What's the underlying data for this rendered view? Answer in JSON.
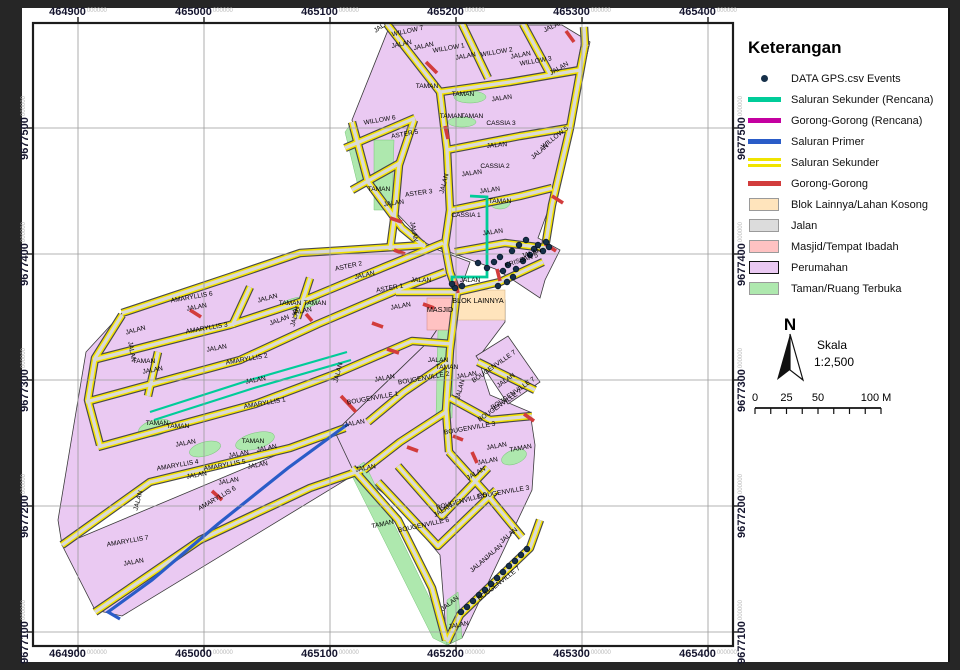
{
  "legend": {
    "title": "Keterangan",
    "items": [
      {
        "name": "gps-events",
        "label": "DATA GPS.csv Events",
        "swatch": "point",
        "color": "#16304a"
      },
      {
        "name": "saluran-sekunder-rencana",
        "label": "Saluran Sekunder (Rencana)",
        "swatch": "line",
        "color": "#00cc99"
      },
      {
        "name": "gorong-gorong-rencana",
        "label": "Gorong-Gorong (Rencana)",
        "swatch": "line",
        "color": "#c400a0"
      },
      {
        "name": "saluran-primer",
        "label": "Saluran Primer",
        "swatch": "line",
        "color": "#2a5cc8"
      },
      {
        "name": "saluran-sekunder",
        "label": "Saluran Sekunder",
        "swatch": "dline",
        "color": "#f0e400"
      },
      {
        "name": "gorong-gorong",
        "label": "Gorong-Gorong",
        "swatch": "line",
        "color": "#d23c3c"
      },
      {
        "name": "blok-lainnya",
        "label": "Blok Lainnya/Lahan Kosong",
        "swatch": "fill",
        "color": "#ffe4bc"
      },
      {
        "name": "jalan",
        "label": "Jalan",
        "swatch": "fill",
        "color": "#dcdcdc"
      },
      {
        "name": "masjid",
        "label": "Masjid/Tempat Ibadah",
        "swatch": "fill",
        "color": "#ffc2c2"
      },
      {
        "name": "perumahan",
        "label": "Perumahan",
        "swatch": "fill-border",
        "color": "#eac9f2"
      },
      {
        "name": "taman",
        "label": "Taman/Ruang Terbuka",
        "swatch": "fill",
        "color": "#aee8ae"
      }
    ]
  },
  "north": {
    "label": "N"
  },
  "scale": {
    "title": "Skala",
    "ratio": "1:2,500",
    "bar_labels": [
      "0",
      "25",
      "50",
      "100 M"
    ]
  },
  "axes": {
    "suffix": "000000",
    "x": [
      {
        "value": "464900",
        "px": 78
      },
      {
        "value": "465000",
        "px": 204
      },
      {
        "value": "465100",
        "px": 330
      },
      {
        "value": "465200",
        "px": 456
      },
      {
        "value": "465300",
        "px": 582
      },
      {
        "value": "465400",
        "px": 708
      }
    ],
    "y": [
      {
        "value": "9677500",
        "px": 128
      },
      {
        "value": "9677400",
        "px": 254
      },
      {
        "value": "9677300",
        "px": 380
      },
      {
        "value": "9677200",
        "px": 506
      },
      {
        "value": "9677100",
        "px": 632
      }
    ]
  },
  "map": {
    "labels": [
      [
        "JALAN",
        384,
        27,
        -35
      ],
      [
        "WILLOW 7",
        408,
        33,
        -12
      ],
      [
        "JALAN",
        402,
        46,
        -12
      ],
      [
        "JALAN",
        424,
        48,
        -12
      ],
      [
        "WILLOW 1",
        449,
        50,
        -10
      ],
      [
        "JALAN",
        466,
        58,
        -10
      ],
      [
        "WILLOW 2",
        497,
        54,
        -10
      ],
      [
        "JALAN",
        521,
        57,
        -10
      ],
      [
        "WILLOW 3",
        536,
        63,
        -10
      ],
      [
        "JALAN",
        554,
        28,
        -25
      ],
      [
        "JALAN",
        560,
        70,
        -30
      ],
      [
        "TAMAN",
        427,
        88,
        0
      ],
      [
        "TAMAN",
        463,
        96,
        0
      ],
      [
        "JALAN",
        502,
        100,
        -8
      ],
      [
        "TAMAN",
        451,
        118,
        0
      ],
      [
        "TAMAN",
        472,
        118,
        0
      ],
      [
        "CASSIA 3",
        501,
        125,
        0
      ],
      [
        "WILLOW 6",
        380,
        122,
        -10
      ],
      [
        "ASTER 5",
        405,
        136,
        -10
      ],
      [
        "WILLOW 5",
        556,
        139,
        -38
      ],
      [
        "JALAN",
        497,
        147,
        -5
      ],
      [
        "JALAN",
        541,
        153,
        -40
      ],
      [
        "TAMAN",
        379,
        191,
        0
      ],
      [
        "JALAN",
        394,
        205,
        -8
      ],
      [
        "ASTER 3",
        419,
        195,
        -8
      ],
      [
        "JALAN",
        446,
        184,
        -75
      ],
      [
        "CASSIA 2",
        495,
        168,
        0
      ],
      [
        "JALAN",
        472,
        175,
        -8
      ],
      [
        "JALAN",
        490,
        192,
        -8
      ],
      [
        "TAMAN",
        500,
        203,
        0
      ],
      [
        "CASSIA 1",
        466,
        217,
        0
      ],
      [
        "JALAN",
        412,
        232,
        80
      ],
      [
        "JALAN",
        493,
        234,
        -8
      ],
      [
        "ASTER 2",
        349,
        268,
        -12
      ],
      [
        "JALAN",
        365,
        277,
        -12
      ],
      [
        "ASTER 1",
        390,
        290,
        -10
      ],
      [
        "JALAN",
        401,
        308,
        -10
      ],
      [
        "JALAN",
        268,
        300,
        -15
      ],
      [
        "AMARYLLIS 6",
        192,
        299,
        -10
      ],
      [
        "JALAN",
        197,
        309,
        -10
      ],
      [
        "TAMAN",
        290,
        305,
        0
      ],
      [
        "TAMAN",
        315,
        305,
        0
      ],
      [
        "JALAN",
        302,
        313,
        -10
      ],
      [
        "JALAN",
        136,
        332,
        -15
      ],
      [
        "AMARYLLIS 3",
        207,
        330,
        -10
      ],
      [
        "JALAN",
        280,
        322,
        -20
      ],
      [
        "JALAN",
        297,
        317,
        -75
      ],
      [
        "JALAN",
        130,
        352,
        80
      ],
      [
        "TAMAN",
        144,
        363,
        0
      ],
      [
        "JALAN",
        153,
        372,
        -10
      ],
      [
        "JALAN",
        217,
        350,
        -10
      ],
      [
        "AMARYLLIS 2",
        247,
        361,
        -10
      ],
      [
        "JALAN",
        256,
        382,
        -10
      ],
      [
        "AMARYLLIS 1",
        265,
        405,
        -10
      ],
      [
        "TAMAN",
        157,
        425,
        0
      ],
      [
        "TAMAN",
        178,
        428,
        0
      ],
      [
        "JALAN",
        186,
        445,
        -10
      ],
      [
        "TAMAN",
        253,
        443,
        0
      ],
      [
        "JALAN",
        239,
        456,
        -10
      ],
      [
        "JALAN",
        267,
        450,
        -10
      ],
      [
        "AMARYLLIS 4",
        178,
        467,
        -10
      ],
      [
        "AMARYLLIS 5",
        225,
        467,
        -10
      ],
      [
        "JALAN",
        258,
        467,
        -10
      ],
      [
        "JALAN",
        197,
        477,
        -10
      ],
      [
        "JALAN",
        229,
        483,
        -10
      ],
      [
        "JALAN",
        140,
        501,
        -75
      ],
      [
        "AMARYLLIS 6",
        218,
        500,
        -30
      ],
      [
        "AMARYLLIS 7",
        128,
        543,
        -10
      ],
      [
        "JALAN",
        134,
        564,
        -10
      ],
      [
        "JALAN",
        340,
        373,
        -75
      ],
      [
        "JALAN",
        385,
        380,
        -10
      ],
      [
        "BOUGENVILLE 2",
        424,
        380,
        -10
      ],
      [
        "JALAN",
        438,
        362,
        0
      ],
      [
        "TAMAN",
        447,
        369,
        0
      ],
      [
        "BOUGENVILLE 1",
        373,
        400,
        -10
      ],
      [
        "JALAN",
        355,
        425,
        -10
      ],
      [
        "BOUGENVILLE 7",
        495,
        368,
        -35
      ],
      [
        "JALAN",
        467,
        377,
        -10
      ],
      [
        "JALAN",
        507,
        382,
        -35
      ],
      [
        "BOUGENVILLE 7",
        514,
        395,
        -35
      ],
      [
        "BOUGENVILLE 7",
        501,
        407,
        -35
      ],
      [
        "JALAN",
        462,
        390,
        -75
      ],
      [
        "BOUGENVILLE 3",
        470,
        430,
        -10
      ],
      [
        "JALAN",
        497,
        448,
        -10
      ],
      [
        "TAMAN",
        521,
        450,
        -10
      ],
      [
        "JALAN",
        488,
        463,
        -10
      ],
      [
        "JALAN",
        366,
        470,
        -10
      ],
      [
        "JALAN",
        477,
        475,
        -30
      ],
      [
        "JALAN",
        444,
        512,
        -30
      ],
      [
        "BOUGENVILLE 5",
        462,
        503,
        -15
      ],
      [
        "BOUGENVILLE 3",
        504,
        494,
        -10
      ],
      [
        "TAMAN",
        383,
        526,
        -12
      ],
      [
        "BOUGENVILLE 6",
        424,
        527,
        -12
      ],
      [
        "JALAN",
        510,
        537,
        -40
      ],
      [
        "JALAN",
        495,
        553,
        -40
      ],
      [
        "JALAN",
        480,
        566,
        -40
      ],
      [
        "BOUGENVILLE 7",
        500,
        585,
        -38
      ],
      [
        "JALAN",
        451,
        605,
        -38
      ],
      [
        "JALAN",
        459,
        627,
        -10
      ],
      [
        "MASJID",
        440,
        312,
        0,
        7.2
      ],
      [
        "BLOK LAINNYA",
        478,
        303,
        0,
        7.2
      ],
      [
        "KRISSAN 5",
        522,
        262,
        -18
      ],
      [
        "JALAN",
        532,
        255,
        -18
      ],
      [
        "JALAN",
        470,
        282,
        0
      ],
      [
        "JALAN",
        421,
        282,
        0
      ]
    ],
    "gps_points": [
      [
        455,
        288
      ],
      [
        462,
        286
      ],
      [
        452,
        284
      ],
      [
        478,
        263
      ],
      [
        487,
        268
      ],
      [
        494,
        262
      ],
      [
        500,
        257
      ],
      [
        503,
        271
      ],
      [
        508,
        265
      ],
      [
        512,
        251
      ],
      [
        516,
        269
      ],
      [
        519,
        245
      ],
      [
        523,
        261
      ],
      [
        526,
        240
      ],
      [
        530,
        255
      ],
      [
        534,
        249
      ],
      [
        538,
        245
      ],
      [
        543,
        251
      ],
      [
        546,
        242
      ],
      [
        549,
        247
      ],
      [
        498,
        286
      ],
      [
        507,
        282
      ],
      [
        513,
        277
      ],
      [
        461,
        612
      ],
      [
        467,
        607
      ],
      [
        473,
        601
      ],
      [
        479,
        595
      ],
      [
        485,
        590
      ],
      [
        491,
        584
      ],
      [
        497,
        578
      ],
      [
        503,
        572
      ],
      [
        509,
        566
      ],
      [
        515,
        561
      ],
      [
        521,
        555
      ],
      [
        527,
        549
      ]
    ]
  },
  "colors": {
    "perumahan": "#eac9f2",
    "taman": "#aee8ae",
    "jalan": "#d9d9d9",
    "saluran_sekunder": "#f6e400",
    "gorong_gorong": "#d23c3c",
    "saluran_sekunder_rencana": "#00cc99",
    "saluran_primer": "#2a5cc8",
    "gorong_gorong_rencana": "#c400a0",
    "blok_lainnya": "#ffe4bc",
    "masjid": "#ffc2c2",
    "gps_dot": "#16304a"
  }
}
